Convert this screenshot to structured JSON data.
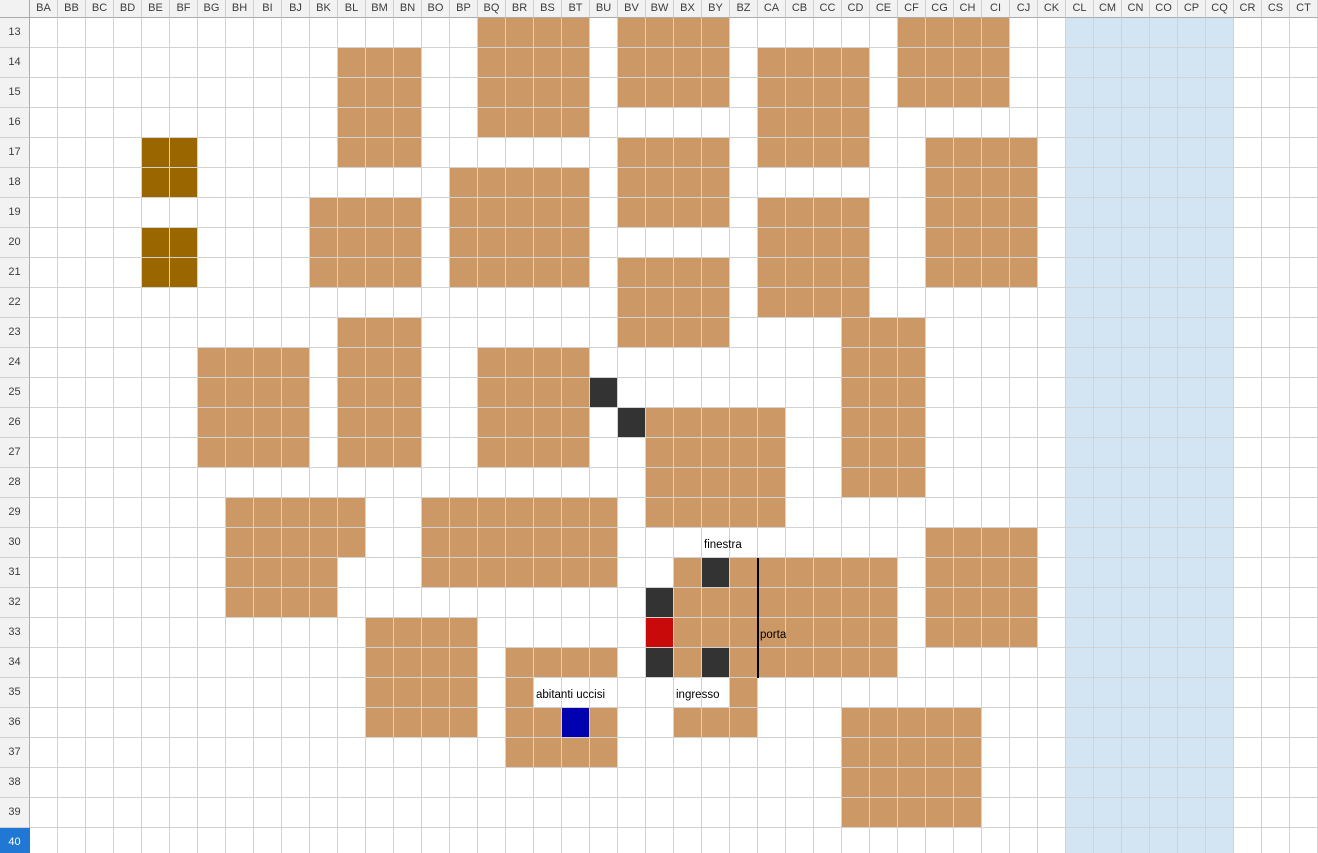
{
  "sheet": {
    "columns": [
      "BA",
      "BB",
      "BC",
      "BD",
      "BE",
      "BF",
      "BG",
      "BH",
      "BI",
      "BJ",
      "BK",
      "BL",
      "BM",
      "BN",
      "BO",
      "BP",
      "BQ",
      "BR",
      "BS",
      "BT",
      "BU",
      "BV",
      "BW",
      "BX",
      "BY",
      "BZ",
      "CA",
      "CB",
      "CC",
      "CD",
      "CE",
      "CF",
      "CG",
      "CH",
      "CI",
      "CJ",
      "CK",
      "CL",
      "CM",
      "CN",
      "CO",
      "CP",
      "CQ",
      "CR",
      "CS",
      "CT"
    ],
    "rows": [
      13,
      14,
      15,
      16,
      17,
      18,
      19,
      20,
      21,
      22,
      23,
      24,
      25,
      26,
      27,
      28,
      29,
      30,
      31,
      32,
      33,
      34,
      35,
      36,
      37,
      38,
      39,
      40
    ],
    "selected_row": 40
  },
  "colors": {
    "tan": "#CC9966",
    "olive": "#996600",
    "dark": "#333333",
    "red": "#C80A0A",
    "navy": "#0000B0",
    "lake": "#D3E5F2",
    "selection": "#2178D4"
  },
  "regions": [
    {
      "c1": "CL",
      "r1": 13,
      "c2": "CQ",
      "r2": 40,
      "color": "lake",
      "name": "lake-region"
    },
    {
      "c1": "BQ",
      "r1": 13,
      "c2": "BT",
      "r2": 16,
      "color": "tan",
      "name": "building"
    },
    {
      "c1": "BV",
      "r1": 13,
      "c2": "BY",
      "r2": 15,
      "color": "tan",
      "name": "building"
    },
    {
      "c1": "CF",
      "r1": 13,
      "c2": "CI",
      "r2": 15,
      "color": "tan",
      "name": "building"
    },
    {
      "c1": "BL",
      "r1": 14,
      "c2": "BN",
      "r2": 17,
      "color": "tan",
      "name": "building"
    },
    {
      "c1": "CA",
      "r1": 14,
      "c2": "CD",
      "r2": 17,
      "color": "tan",
      "name": "building"
    },
    {
      "c1": "BV",
      "r1": 17,
      "c2": "BY",
      "r2": 19,
      "color": "tan",
      "name": "building"
    },
    {
      "c1": "CG",
      "r1": 17,
      "c2": "CJ",
      "r2": 21,
      "color": "tan",
      "name": "building"
    },
    {
      "c1": "BP",
      "r1": 18,
      "c2": "BT",
      "r2": 21,
      "color": "tan",
      "name": "building"
    },
    {
      "c1": "BK",
      "r1": 19,
      "c2": "BN",
      "r2": 21,
      "color": "tan",
      "name": "building"
    },
    {
      "c1": "CA",
      "r1": 19,
      "c2": "CD",
      "r2": 22,
      "color": "tan",
      "name": "building"
    },
    {
      "c1": "BV",
      "r1": 21,
      "c2": "BY",
      "r2": 23,
      "color": "tan",
      "name": "building"
    },
    {
      "c1": "BL",
      "r1": 23,
      "c2": "BN",
      "r2": 27,
      "color": "tan",
      "name": "building"
    },
    {
      "c1": "CD",
      "r1": 23,
      "c2": "CF",
      "r2": 28,
      "color": "tan",
      "name": "building"
    },
    {
      "c1": "BG",
      "r1": 24,
      "c2": "BJ",
      "r2": 27,
      "color": "tan",
      "name": "building"
    },
    {
      "c1": "BQ",
      "r1": 24,
      "c2": "BT",
      "r2": 27,
      "color": "tan",
      "name": "building"
    },
    {
      "c1": "BW",
      "r1": 26,
      "c2": "CA",
      "r2": 29,
      "color": "tan",
      "name": "building"
    },
    {
      "c1": "BH",
      "r1": 29,
      "c2": "BL",
      "r2": 30,
      "color": "tan",
      "name": "building"
    },
    {
      "c1": "BO",
      "r1": 29,
      "c2": "BU",
      "r2": 31,
      "color": "tan",
      "name": "building"
    },
    {
      "c1": "CG",
      "r1": 30,
      "c2": "CJ",
      "r2": 33,
      "color": "tan",
      "name": "building"
    },
    {
      "c1": "BH",
      "r1": 31,
      "c2": "BK",
      "r2": 32,
      "color": "tan",
      "name": "building"
    },
    {
      "c1": "BX",
      "r1": 31,
      "c2": "BX",
      "r2": 31,
      "color": "tan",
      "name": "building"
    },
    {
      "c1": "BZ",
      "r1": 31,
      "c2": "CE",
      "r2": 34,
      "color": "tan",
      "name": "building"
    },
    {
      "c1": "BX",
      "r1": 32,
      "c2": "BY",
      "r2": 33,
      "color": "tan",
      "name": "building"
    },
    {
      "c1": "BX",
      "r1": 34,
      "c2": "BX",
      "r2": 34,
      "color": "tan",
      "name": "building"
    },
    {
      "c1": "BM",
      "r1": 33,
      "c2": "BP",
      "r2": 36,
      "color": "tan",
      "name": "building"
    },
    {
      "c1": "BR",
      "r1": 34,
      "c2": "BU",
      "r2": 34,
      "color": "tan",
      "name": "building"
    },
    {
      "c1": "BR",
      "r1": 35,
      "c2": "BR",
      "r2": 35,
      "color": "tan",
      "name": "building"
    },
    {
      "c1": "BZ",
      "r1": 35,
      "c2": "BZ",
      "r2": 35,
      "color": "tan",
      "name": "building"
    },
    {
      "c1": "BR",
      "r1": 36,
      "c2": "BS",
      "r2": 36,
      "color": "tan",
      "name": "building"
    },
    {
      "c1": "BU",
      "r1": 36,
      "c2": "BU",
      "r2": 36,
      "color": "tan",
      "name": "building"
    },
    {
      "c1": "BX",
      "r1": 36,
      "c2": "BZ",
      "r2": 36,
      "color": "tan",
      "name": "building"
    },
    {
      "c1": "BR",
      "r1": 37,
      "c2": "BU",
      "r2": 37,
      "color": "tan",
      "name": "building"
    },
    {
      "c1": "CD",
      "r1": 36,
      "c2": "CH",
      "r2": 39,
      "color": "tan",
      "name": "building"
    },
    {
      "c1": "BE",
      "r1": 17,
      "c2": "BF",
      "r2": 18,
      "color": "olive",
      "name": "olive-block"
    },
    {
      "c1": "BE",
      "r1": 20,
      "c2": "BF",
      "r2": 21,
      "color": "olive",
      "name": "olive-block"
    },
    {
      "c1": "BU",
      "r1": 25,
      "c2": "BU",
      "r2": 25,
      "color": "dark",
      "name": "dark-cell"
    },
    {
      "c1": "BV",
      "r1": 26,
      "c2": "BV",
      "r2": 26,
      "color": "dark",
      "name": "dark-cell"
    },
    {
      "c1": "BY",
      "r1": 31,
      "c2": "BY",
      "r2": 31,
      "color": "dark",
      "name": "dark-cell"
    },
    {
      "c1": "BW",
      "r1": 32,
      "c2": "BW",
      "r2": 32,
      "color": "dark",
      "name": "dark-cell"
    },
    {
      "c1": "BW",
      "r1": 34,
      "c2": "BW",
      "r2": 34,
      "color": "dark",
      "name": "dark-cell"
    },
    {
      "c1": "BY",
      "r1": 34,
      "c2": "BY",
      "r2": 34,
      "color": "dark",
      "name": "dark-cell"
    },
    {
      "c1": "BW",
      "r1": 33,
      "c2": "BW",
      "r2": 33,
      "color": "red",
      "name": "red-cell"
    },
    {
      "c1": "BT",
      "r1": 36,
      "c2": "BT",
      "r2": 36,
      "color": "navy",
      "name": "navy-cell"
    }
  ],
  "labels": [
    {
      "text": "finestra",
      "col": "BY",
      "row": 30
    },
    {
      "text": "porta",
      "col": "CA",
      "row": 33
    },
    {
      "text": "ingresso",
      "col": "BX",
      "row": 35
    },
    {
      "text": "abitanti uccisi",
      "col": "BS",
      "row": 35
    }
  ],
  "door_line": {
    "boundary_col": "CA",
    "row_start": 31,
    "row_end": 34
  }
}
